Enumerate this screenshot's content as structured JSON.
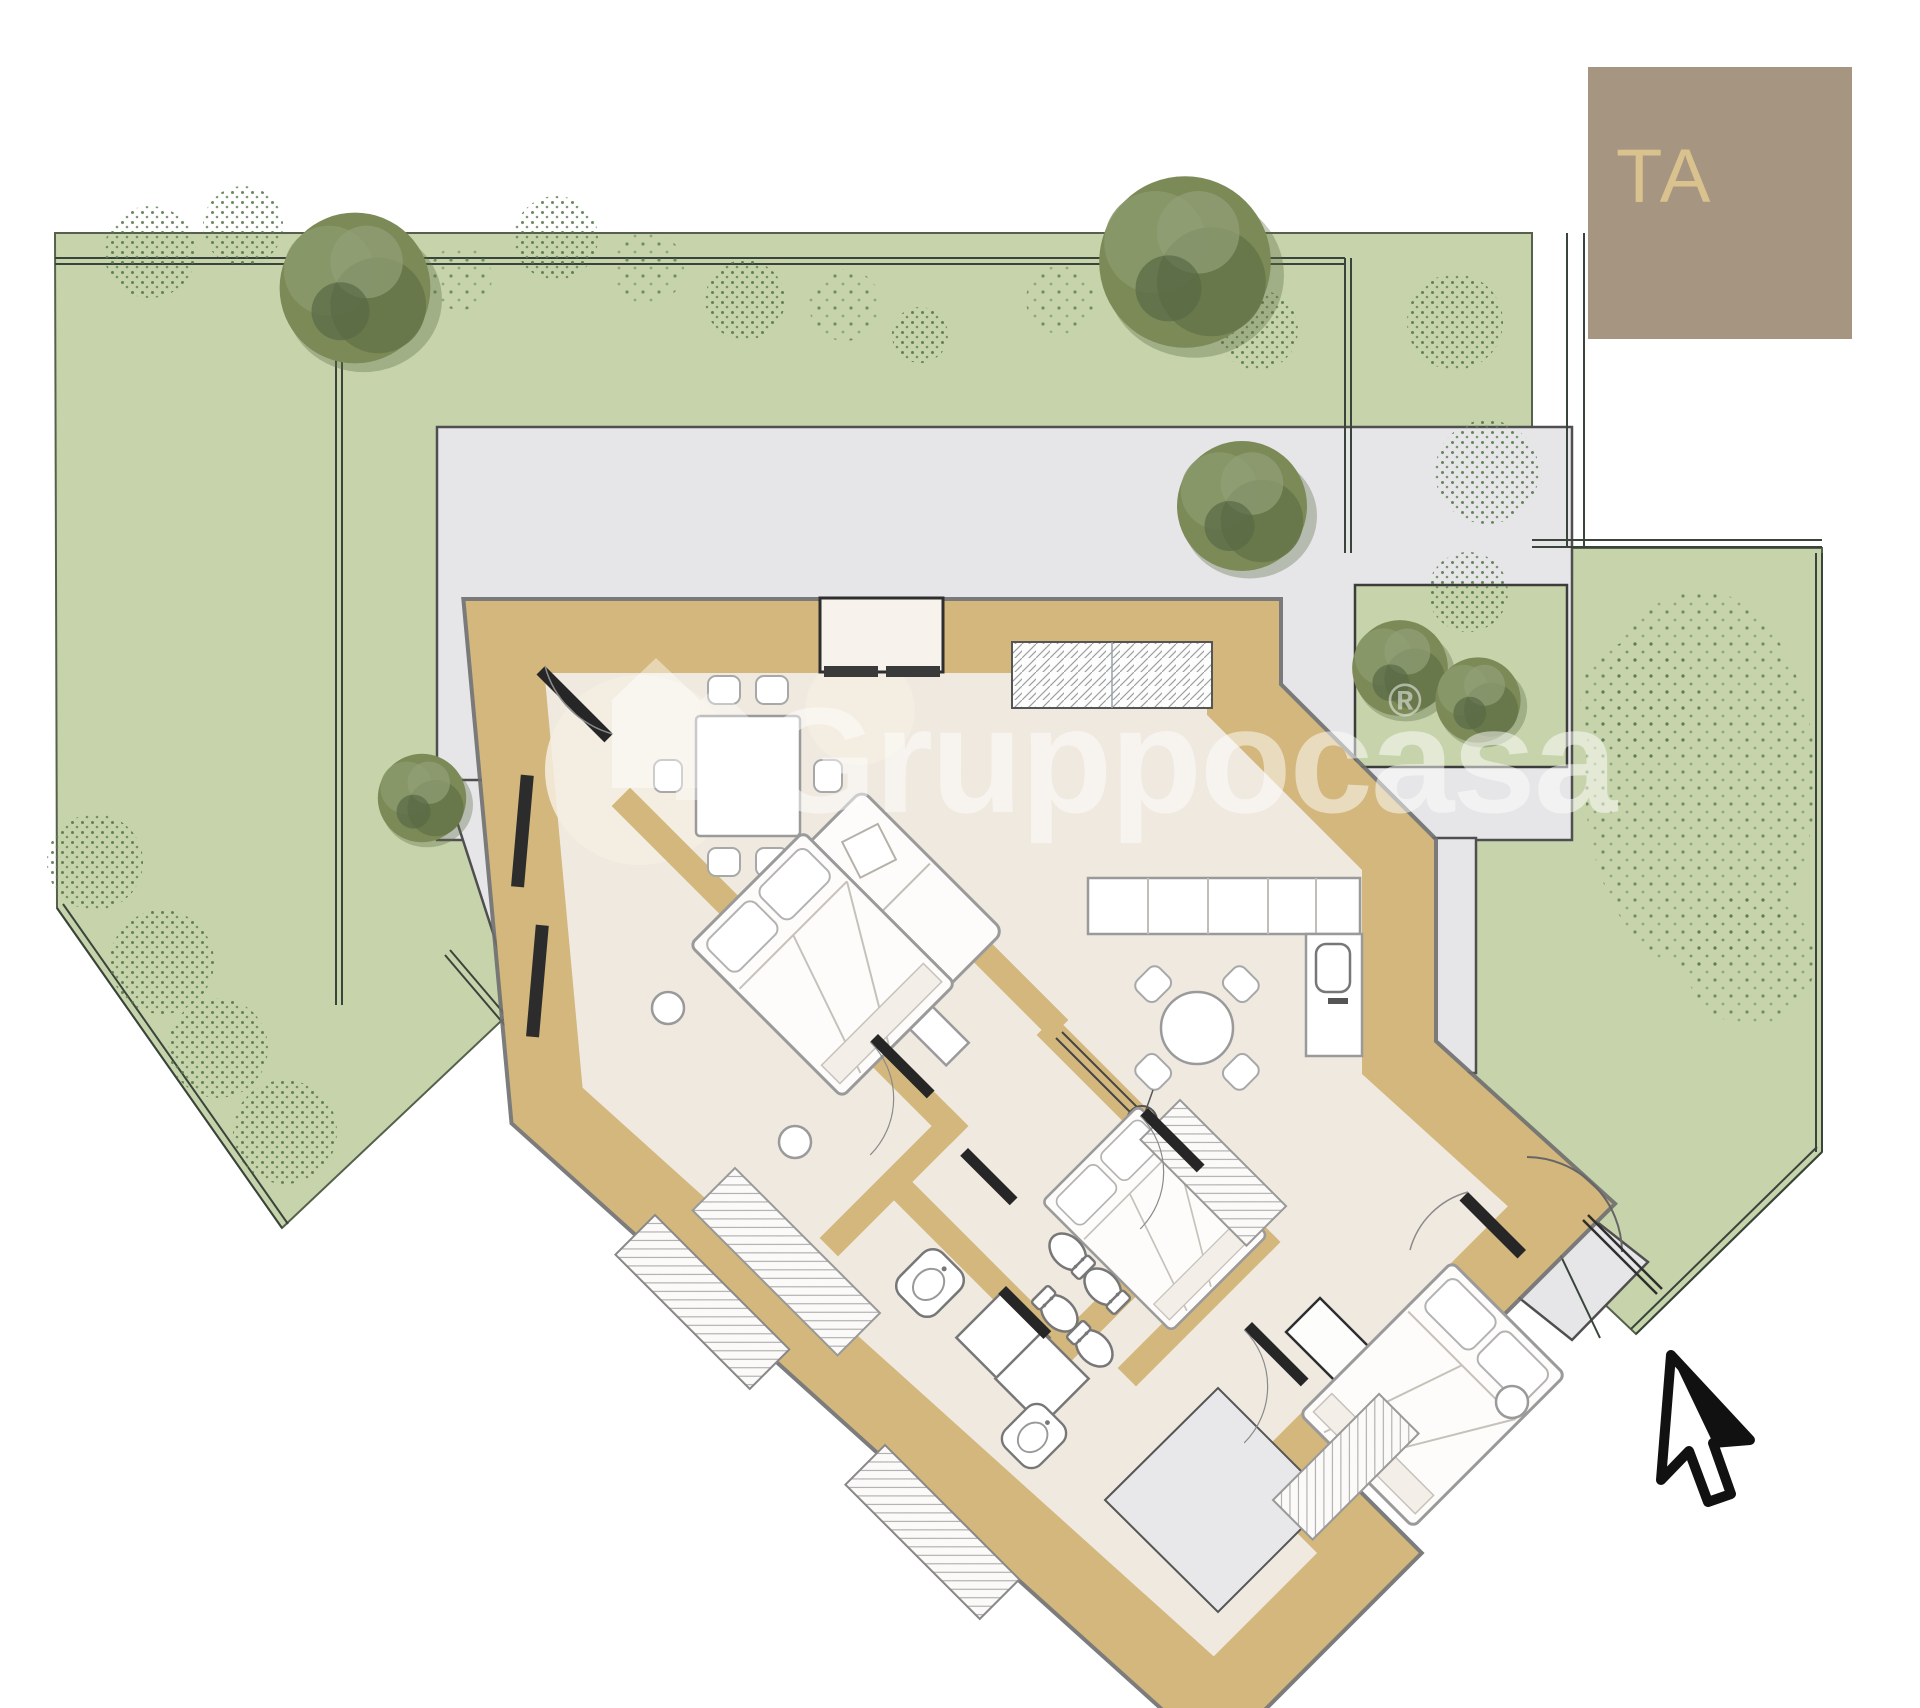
{
  "title_block": {
    "label": "TA"
  },
  "watermark": {
    "brand": "Gruppocasa",
    "registered_mark": "®"
  },
  "compass_symbol": {
    "label": "N"
  },
  "palette": {
    "lawn": "#c7d4ab",
    "lawn_border": "#55614b",
    "terrace": "#e6e6e8",
    "terrace_border": "#4f4f4f",
    "walls": "#d3b77c",
    "interior": "#efe9e0",
    "furniture_stroke": "#9a9a9a",
    "door": "#262626",
    "title_block_bg": "#a69681",
    "title_block_text": "#d9c28e",
    "tree_olive": "#7c8a57",
    "bush_stipple": "#4e7342",
    "watermark_white": "#ffffff"
  }
}
